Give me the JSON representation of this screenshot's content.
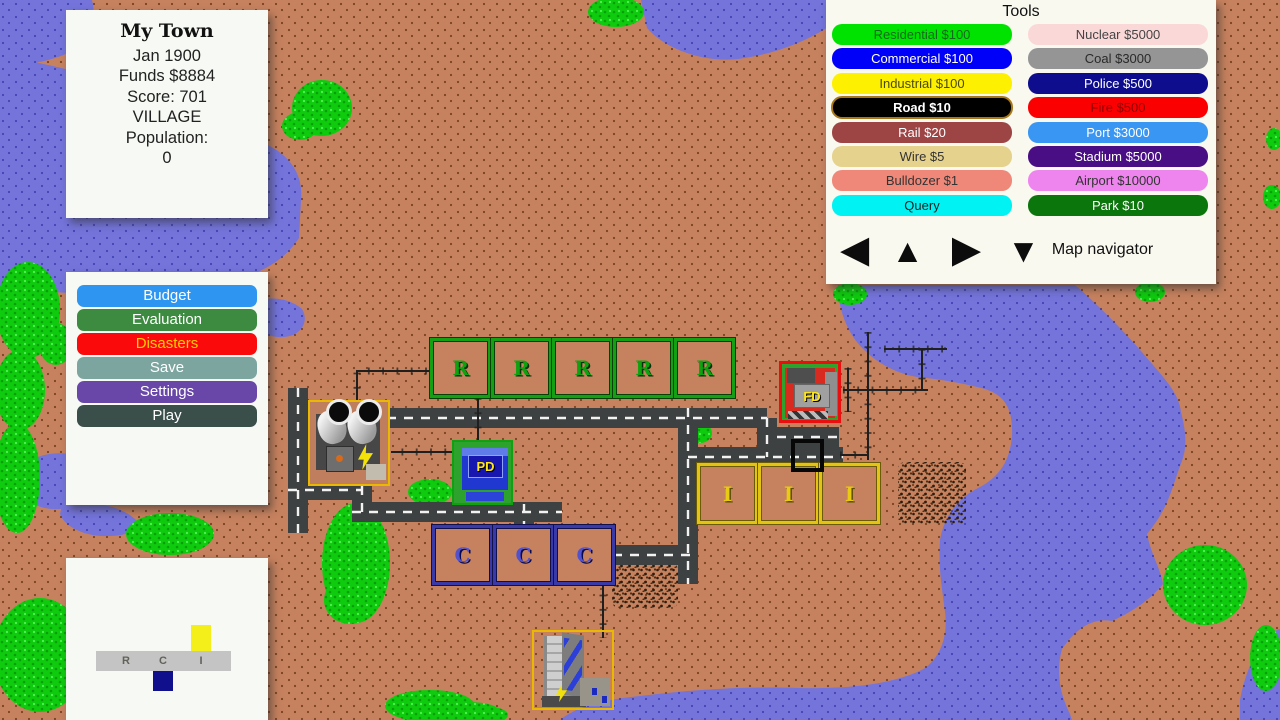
{
  "info_panel": {
    "title": "My Town",
    "lines": [
      "Jan 1900",
      "Funds $8884",
      "Score: 701",
      "VILLAGE",
      "Population:",
      "0"
    ]
  },
  "menu_panel": {
    "buttons": [
      {
        "id": "budget",
        "label": "Budget",
        "bg": "#2e96f0",
        "fg": "#ffffff"
      },
      {
        "id": "evaluation",
        "label": "Evaluation",
        "bg": "#3c8b40",
        "fg": "#ffffff"
      },
      {
        "id": "disasters",
        "label": "Disasters",
        "bg": "#fa0a0a",
        "fg": "#ffcc00"
      },
      {
        "id": "save",
        "label": "Save",
        "bg": "#7da5a0",
        "fg": "#ffffff"
      },
      {
        "id": "settings",
        "label": "Settings",
        "bg": "#6847a8",
        "fg": "#ffffff"
      },
      {
        "id": "play",
        "label": "Play",
        "bg": "#3a4f4a",
        "fg": "#ffffff"
      }
    ]
  },
  "rci_panel": {
    "letters": [
      "R",
      "C",
      "I"
    ],
    "bars": [
      {
        "letter": "R",
        "demand": 0,
        "color": "#c4c4c4"
      },
      {
        "letter": "C",
        "demand": -20,
        "color": "#10108c"
      },
      {
        "letter": "I",
        "demand": 26,
        "color": "#f4ef1b"
      }
    ]
  },
  "tools_panel": {
    "title": "Tools",
    "columns": [
      [
        {
          "label": "Residential $100",
          "bg": "#00e300",
          "fg": "#14691c"
        },
        {
          "label": "Commercial $100",
          "bg": "#0000f8",
          "fg": "#ffffff"
        },
        {
          "label": "Industrial $100",
          "bg": "#fdf000",
          "fg": "#4a4a10"
        },
        {
          "label": "Road $10",
          "bg": "#000000",
          "fg": "#ffffff",
          "bold": true,
          "selected": true
        },
        {
          "label": "Rail $20",
          "bg": "#9d4545",
          "fg": "#ffffff"
        },
        {
          "label": "Wire $5",
          "bg": "#e5d28d",
          "fg": "#333333"
        },
        {
          "label": "Bulldozer $1",
          "bg": "#ef8878",
          "fg": "#333333"
        },
        {
          "label": "Query",
          "bg": "#00f2f2",
          "fg": "#222222"
        }
      ],
      [
        {
          "label": "Nuclear $5000",
          "bg": "#fbd8d8",
          "fg": "#444444"
        },
        {
          "label": "Coal $3000",
          "bg": "#959595",
          "fg": "#2a2a2a"
        },
        {
          "label": "Police $500",
          "bg": "#0d0d8d",
          "fg": "#ffffff"
        },
        {
          "label": "Fire $500",
          "bg": "#fb0000",
          "fg": "#8f0000"
        },
        {
          "label": "Port $3000",
          "bg": "#3996f2",
          "fg": "#ffffff"
        },
        {
          "label": "Stadium $5000",
          "bg": "#4a0e84",
          "fg": "#ffffff"
        },
        {
          "label": "Airport $10000",
          "bg": "#ee85ee",
          "fg": "#333333"
        },
        {
          "label": "Park $10",
          "bg": "#0b760b",
          "fg": "#ffffff"
        }
      ]
    ],
    "navigator": {
      "label": "Map navigator",
      "arrows": [
        {
          "dir": "left",
          "glyph": "◀"
        },
        {
          "dir": "up",
          "glyph": "▲"
        },
        {
          "dir": "right",
          "glyph": "▶"
        },
        {
          "dir": "down",
          "glyph": "▼"
        }
      ]
    }
  },
  "map": {
    "zone_styles": {
      "R": {
        "border": "#13a013",
        "edge": "#073f07",
        "fill": "#c6825f",
        "letter_color": "#0fa10f",
        "letter_shadow": "#062e06"
      },
      "C": {
        "border": "#3939a8",
        "edge": "#10104d",
        "fill": "#c6825f",
        "letter_color": "#5252cf",
        "letter_shadow": "#0a0a4d"
      },
      "I": {
        "border": "#e3c414",
        "edge": "#6b5a06",
        "fill": "#c6825f",
        "letter_color": "#e8ca12",
        "letter_shadow": "#5c4c04"
      }
    },
    "zones": [
      {
        "type": "R",
        "letter": "R",
        "x": 430,
        "y": 338,
        "w": 61,
        "h": 60
      },
      {
        "type": "R",
        "letter": "R",
        "x": 491,
        "y": 338,
        "w": 61,
        "h": 60
      },
      {
        "type": "R",
        "letter": "R",
        "x": 552,
        "y": 338,
        "w": 61,
        "h": 60
      },
      {
        "type": "R",
        "letter": "R",
        "x": 613,
        "y": 338,
        "w": 61,
        "h": 60
      },
      {
        "type": "R",
        "letter": "R",
        "x": 674,
        "y": 338,
        "w": 61,
        "h": 60
      },
      {
        "type": "I",
        "letter": "I",
        "x": 697,
        "y": 463,
        "w": 61,
        "h": 61
      },
      {
        "type": "I",
        "letter": "I",
        "x": 758,
        "y": 463,
        "w": 61,
        "h": 61
      },
      {
        "type": "I",
        "letter": "I",
        "x": 819,
        "y": 463,
        "w": 61,
        "h": 61
      },
      {
        "type": "C",
        "letter": "C",
        "x": 432,
        "y": 525,
        "w": 61,
        "h": 60
      },
      {
        "type": "C",
        "letter": "C",
        "x": 493,
        "y": 525,
        "w": 61,
        "h": 60
      },
      {
        "type": "C",
        "letter": "C",
        "x": 554,
        "y": 525,
        "w": 61,
        "h": 60
      }
    ],
    "buildings": {
      "power_plant": {
        "name": "coal-power-plant"
      },
      "police": {
        "label": "PD"
      },
      "fire": {
        "label": "FD"
      },
      "industrial": {
        "name": "industrial-building"
      }
    },
    "cursor": {
      "x": 791,
      "y": 439,
      "size": 33
    },
    "roads": [
      [
        [
          362,
          512
        ],
        [
          362,
          418
        ],
        [
          767,
          418
        ]
      ],
      [
        [
          352,
          512
        ],
        [
          562,
          512
        ]
      ],
      [
        [
          524,
          504
        ],
        [
          524,
          528
        ]
      ],
      [
        [
          767,
          418
        ],
        [
          767,
          457
        ]
      ],
      [
        [
          688,
          457
        ],
        [
          843,
          457
        ]
      ],
      [
        [
          777,
          437
        ],
        [
          839,
          437
        ]
      ],
      [
        [
          688,
          408
        ],
        [
          688,
          584
        ]
      ],
      [
        [
          613,
          555
        ],
        [
          690,
          555
        ]
      ],
      [
        [
          298,
          388
        ],
        [
          298,
          533
        ]
      ],
      [
        [
          288,
          490
        ],
        [
          363,
          490
        ]
      ]
    ],
    "wires": [
      [
        [
          357,
          403
        ],
        [
          357,
          371
        ],
        [
          431,
          371
        ]
      ],
      [
        [
          478,
          398
        ],
        [
          478,
          452
        ],
        [
          391,
          452
        ]
      ],
      [
        [
          603,
          566
        ],
        [
          603,
          638
        ]
      ],
      [
        [
          868,
          332
        ],
        [
          868,
          460
        ]
      ],
      [
        [
          843,
          390
        ],
        [
          928,
          390
        ]
      ],
      [
        [
          884,
          349
        ],
        [
          947,
          349
        ]
      ],
      [
        [
          922,
          349
        ],
        [
          922,
          390
        ]
      ],
      [
        [
          840,
          455
        ],
        [
          868,
          455
        ]
      ],
      [
        [
          848,
          368
        ],
        [
          848,
          412
        ]
      ]
    ],
    "water": [
      "M0,0 L92,0 C98,24 88,47 58,57 C34,65 10,67 0,61 Z",
      "M0,55 C45,64 105,76 155,96 C196,113 248,132 278,151 C295,163 303,180 301,200 L299,238 C284,261 262,272 236,280 C178,295 98,296 40,291 L0,287 Z",
      "M253,303 C268,295 290,298 302,309 C308,319 304,330 293,335 C277,341 259,334 253,322 Z",
      "M25,466 C35,452 72,448 88,462 C98,474 96,492 82,502 C62,514 34,510 25,496 C20,486 20,476 25,466 Z",
      "M62,505 C90,499 122,506 136,520 C140,530 128,536 108,536 C84,537 64,526 60,514 Z",
      "M641,0 L834,0 L830,26 C802,44 770,55 738,59 C702,63 664,48 647,28 Z",
      "M838,285 L1075,285 C1096,303 1121,328 1141,351 C1162,376 1179,392 1181,412 C1186,432 1188,448 1180,466 C1170,494 1168,508 1147,534 C1151,554 1161,570 1163,584 C1150,600 1132,612 1112,621 C1094,618 1078,626 1062,649 C1056,670 1059,692 1070,714 L1072,720 L560,720 C575,708 598,700 640,696 C690,690 740,686 800,688 C858,689 900,682 925,668 C941,656 948,636 945,612 C942,588 938,566 940,540 C944,516 958,498 978,488 C1000,477 1010,460 1012,436 C1013,414 1008,396 985,389 C962,383 938,379 917,377 C894,373 872,361 856,341 C845,326 838,306 838,285 Z",
      "M1240,720 L1240,700 C1246,668 1258,645 1272,634 C1276,630 1279,629 1280,629 L1280,720 Z"
    ],
    "trees": [
      {
        "cx": 322,
        "cy": 108,
        "rx": 30,
        "ry": 28
      },
      {
        "cx": 300,
        "cy": 126,
        "rx": 18,
        "ry": 14
      },
      {
        "cx": 616,
        "cy": 12,
        "rx": 28,
        "ry": 15
      },
      {
        "cx": 28,
        "cy": 310,
        "rx": 32,
        "ry": 48
      },
      {
        "cx": 56,
        "cy": 344,
        "rx": 17,
        "ry": 21
      },
      {
        "cx": 20,
        "cy": 390,
        "rx": 25,
        "ry": 40
      },
      {
        "cx": 17,
        "cy": 478,
        "rx": 23,
        "ry": 55
      },
      {
        "cx": 40,
        "cy": 655,
        "rx": 47,
        "ry": 57
      },
      {
        "cx": 170,
        "cy": 534,
        "rx": 44,
        "ry": 21
      },
      {
        "cx": 356,
        "cy": 563,
        "rx": 34,
        "ry": 60
      },
      {
        "cx": 350,
        "cy": 600,
        "rx": 26,
        "ry": 24
      },
      {
        "cx": 430,
        "cy": 492,
        "rx": 22,
        "ry": 13
      },
      {
        "cx": 700,
        "cy": 433,
        "rx": 12,
        "ry": 10
      },
      {
        "cx": 430,
        "cy": 706,
        "rx": 45,
        "ry": 16
      },
      {
        "cx": 470,
        "cy": 712,
        "rx": 30,
        "ry": 10
      },
      {
        "cx": 490,
        "cy": 715,
        "rx": 18,
        "ry": 8
      },
      {
        "cx": 1205,
        "cy": 585,
        "rx": 42,
        "ry": 40
      },
      {
        "cx": 1266,
        "cy": 658,
        "rx": 16,
        "ry": 33
      },
      {
        "cx": 1274,
        "cy": 139,
        "rx": 8,
        "ry": 11
      },
      {
        "cx": 1272,
        "cy": 197,
        "rx": 9,
        "ry": 12
      },
      {
        "cx": 850,
        "cy": 294,
        "rx": 17,
        "ry": 11
      },
      {
        "cx": 1150,
        "cy": 292,
        "rx": 15,
        "ry": 10
      }
    ],
    "rubble": [
      {
        "x": 898,
        "y": 462,
        "w": 68,
        "h": 62
      },
      {
        "x": 612,
        "y": 563,
        "w": 66,
        "h": 45
      }
    ]
  }
}
